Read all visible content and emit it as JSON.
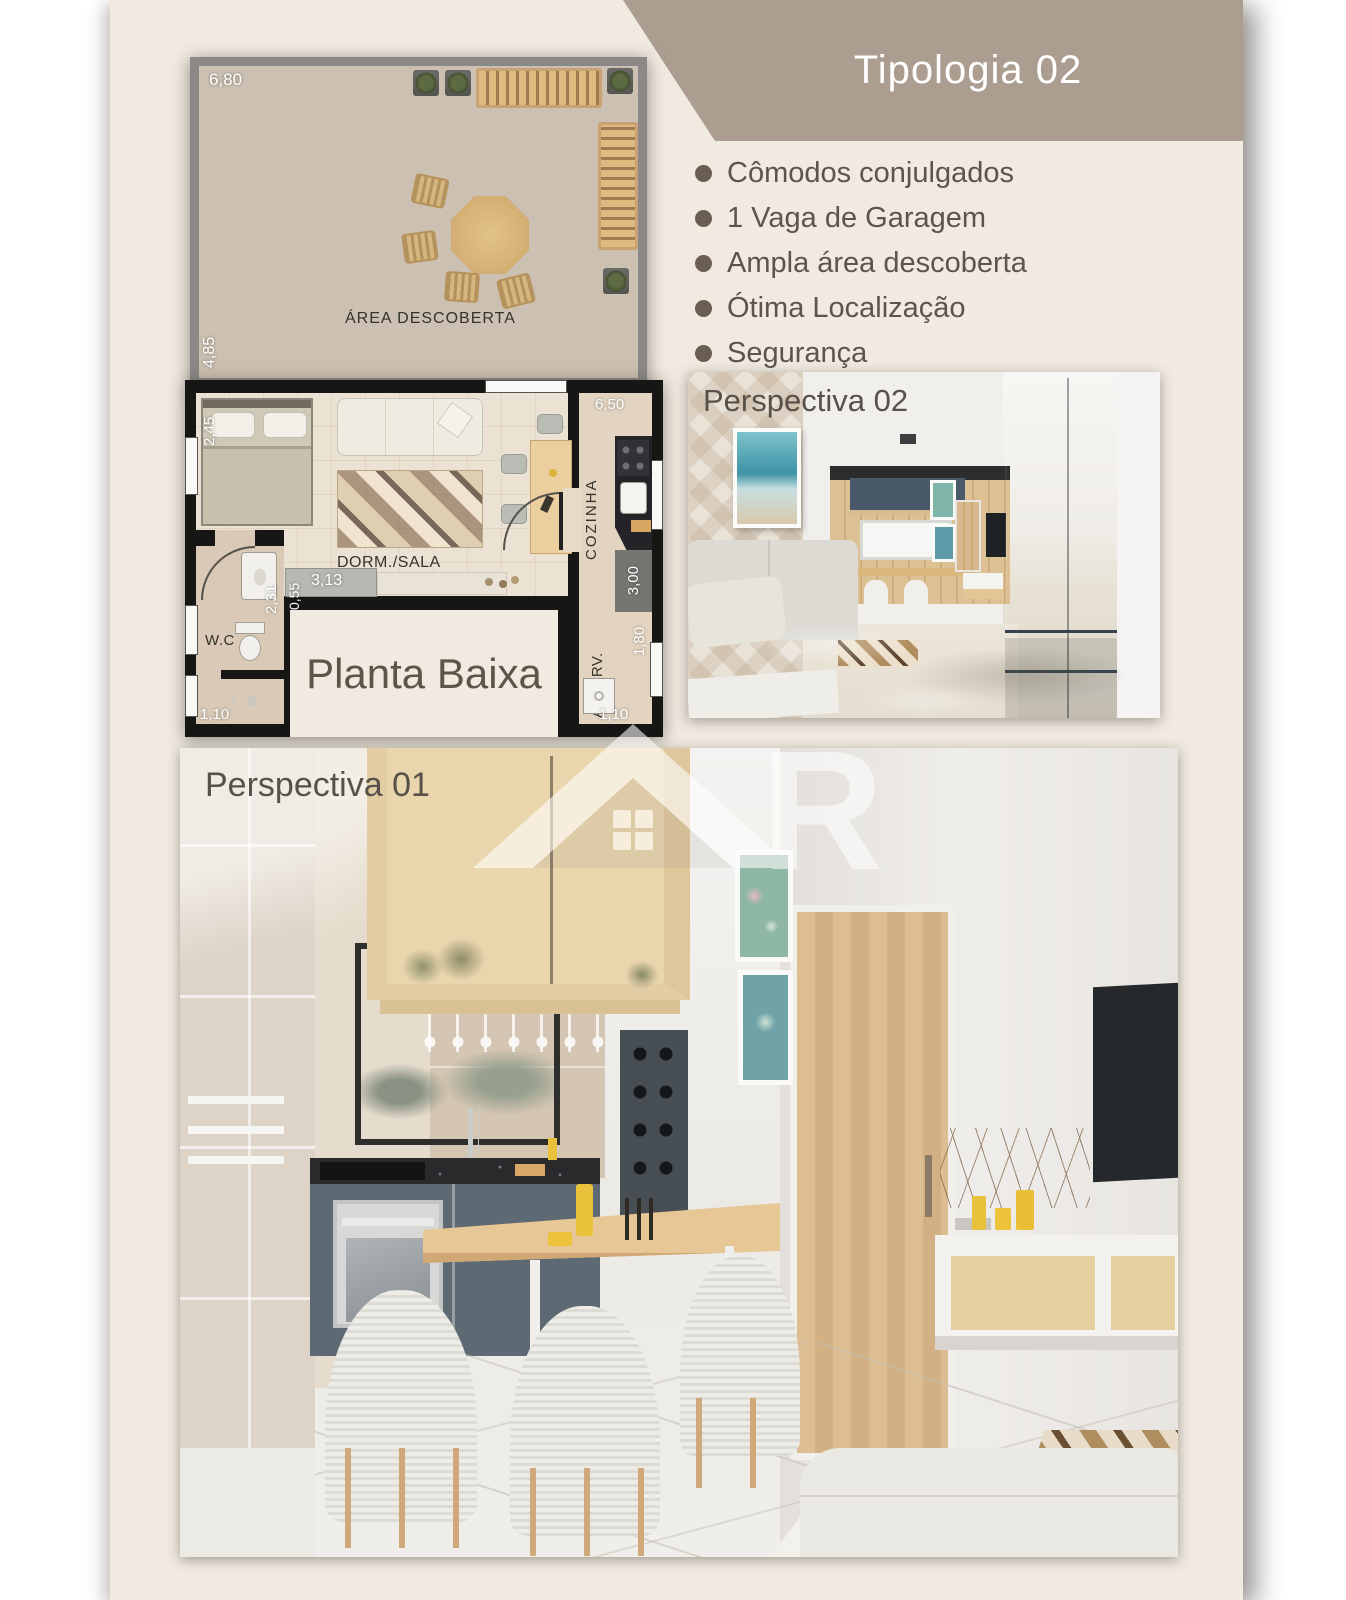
{
  "banner": {
    "title": "Tipologia 02"
  },
  "features": [
    {
      "label": "Cômodos conjulgados"
    },
    {
      "label": "1 Vaga de Garagem"
    },
    {
      "label": "Ampla área descoberta"
    },
    {
      "label": "Ótima Localização"
    },
    {
      "label": "Segurança"
    }
  ],
  "floorplan": {
    "title": "Planta Baixa",
    "labels": {
      "terrace": "ÁREA DESCOBERTA",
      "living": "DORM./SALA",
      "kitchen": "COZINHA",
      "bathroom": "W.C",
      "laundry": "A. SERV."
    },
    "dims": {
      "terrace_w": "6,80",
      "terrace_h": "4,85",
      "bed_wall": "2,45",
      "kitchen_top": "6,50",
      "console_depth": "0,55",
      "console_width": "3,13",
      "wc_height": "2,31",
      "kitchen_right": "3,00",
      "laundry_height": "1,80",
      "wc_bottom": "1,10",
      "laundry_bottom": "1,10"
    }
  },
  "perspectives": [
    {
      "label": "Perspectiva 02"
    },
    {
      "label": "Perspectiva 01"
    }
  ],
  "watermark": {
    "letter": "R"
  },
  "colors": {
    "page_bg": "#f0eae0",
    "banner_bg": "#ab9d8f",
    "banner_text": "#ffffff",
    "bullet": "#6a5e52",
    "body_text": "#5d554b",
    "plan_wall": "#161615",
    "terrace_floor": "#cbc0b1",
    "room_floor": "#ece2d4",
    "wardrobe_blue": "#56666f",
    "wood": "#dcba80"
  }
}
